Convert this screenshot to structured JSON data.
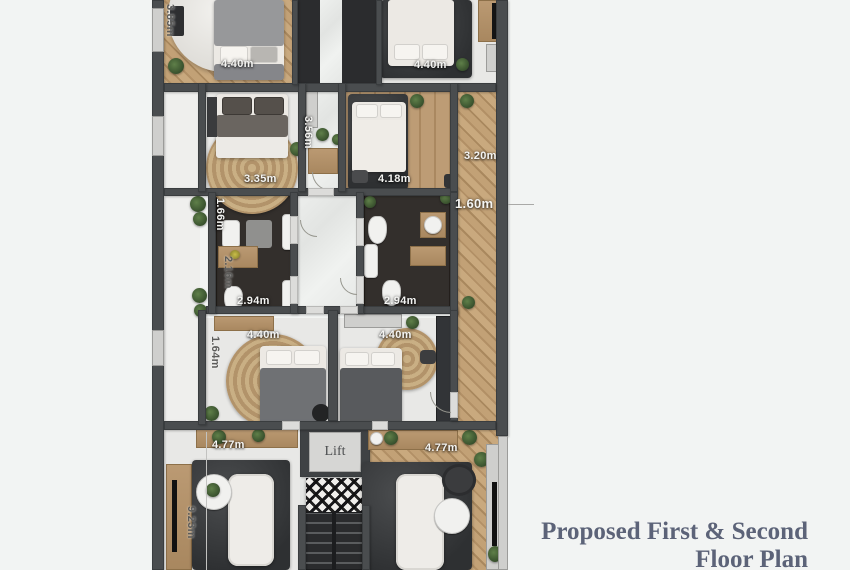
{
  "title": {
    "line1": "Proposed First & Second",
    "line2": "Floor Plan"
  },
  "plan": {
    "lift_label": "Lift",
    "dimensions": [
      {
        "label": "3.85m",
        "orientation": "vertical",
        "location": "top-left-exterior"
      },
      {
        "label": "4.40m",
        "orientation": "horizontal",
        "location": "top-left-bedroom"
      },
      {
        "label": "4.40m",
        "orientation": "horizontal",
        "location": "top-right-bedroom"
      },
      {
        "label": "3.56m",
        "orientation": "vertical",
        "location": "center-hall"
      },
      {
        "label": "3.35m",
        "orientation": "horizontal",
        "location": "second-left-bedroom"
      },
      {
        "label": "4.18m",
        "orientation": "horizontal",
        "location": "second-right-bedroom"
      },
      {
        "label": "3.20m",
        "orientation": "horizontal",
        "location": "right-corridor-upper"
      },
      {
        "label": "1.60m",
        "orientation": "horizontal",
        "location": "right-corridor-lower"
      },
      {
        "label": "1.66m",
        "orientation": "vertical",
        "location": "left-bathroom-upper"
      },
      {
        "label": "2.16m",
        "orientation": "vertical",
        "location": "left-bathroom-lower"
      },
      {
        "label": "2.94m",
        "orientation": "horizontal",
        "location": "left-bathroom"
      },
      {
        "label": "2.94m",
        "orientation": "horizontal",
        "location": "right-bathroom"
      },
      {
        "label": "4.40m",
        "orientation": "horizontal",
        "location": "third-left-bedroom"
      },
      {
        "label": "4.40m",
        "orientation": "horizontal",
        "location": "third-right-bedroom"
      },
      {
        "label": "1.64m",
        "orientation": "vertical",
        "location": "third-left-bedroom-side"
      },
      {
        "label": "4.77m",
        "orientation": "horizontal",
        "location": "left-living-room"
      },
      {
        "label": "4.77m",
        "orientation": "horizontal",
        "location": "right-living-room"
      },
      {
        "label": "9.23m",
        "orientation": "vertical",
        "location": "left-living-room-side"
      }
    ]
  },
  "colors": {
    "background": "#f2f4f3",
    "wall": "#4a4d4f",
    "wood_floor": "#bf9f76",
    "dark_rug": "#3b3d3f",
    "light_floor": "#e8e8e6",
    "bathroom_tile": "#332f2c",
    "title_text": "#5c6378",
    "dimension_text_light": "#f4f4f2",
    "dimension_text_dark": "#5b5b59"
  }
}
